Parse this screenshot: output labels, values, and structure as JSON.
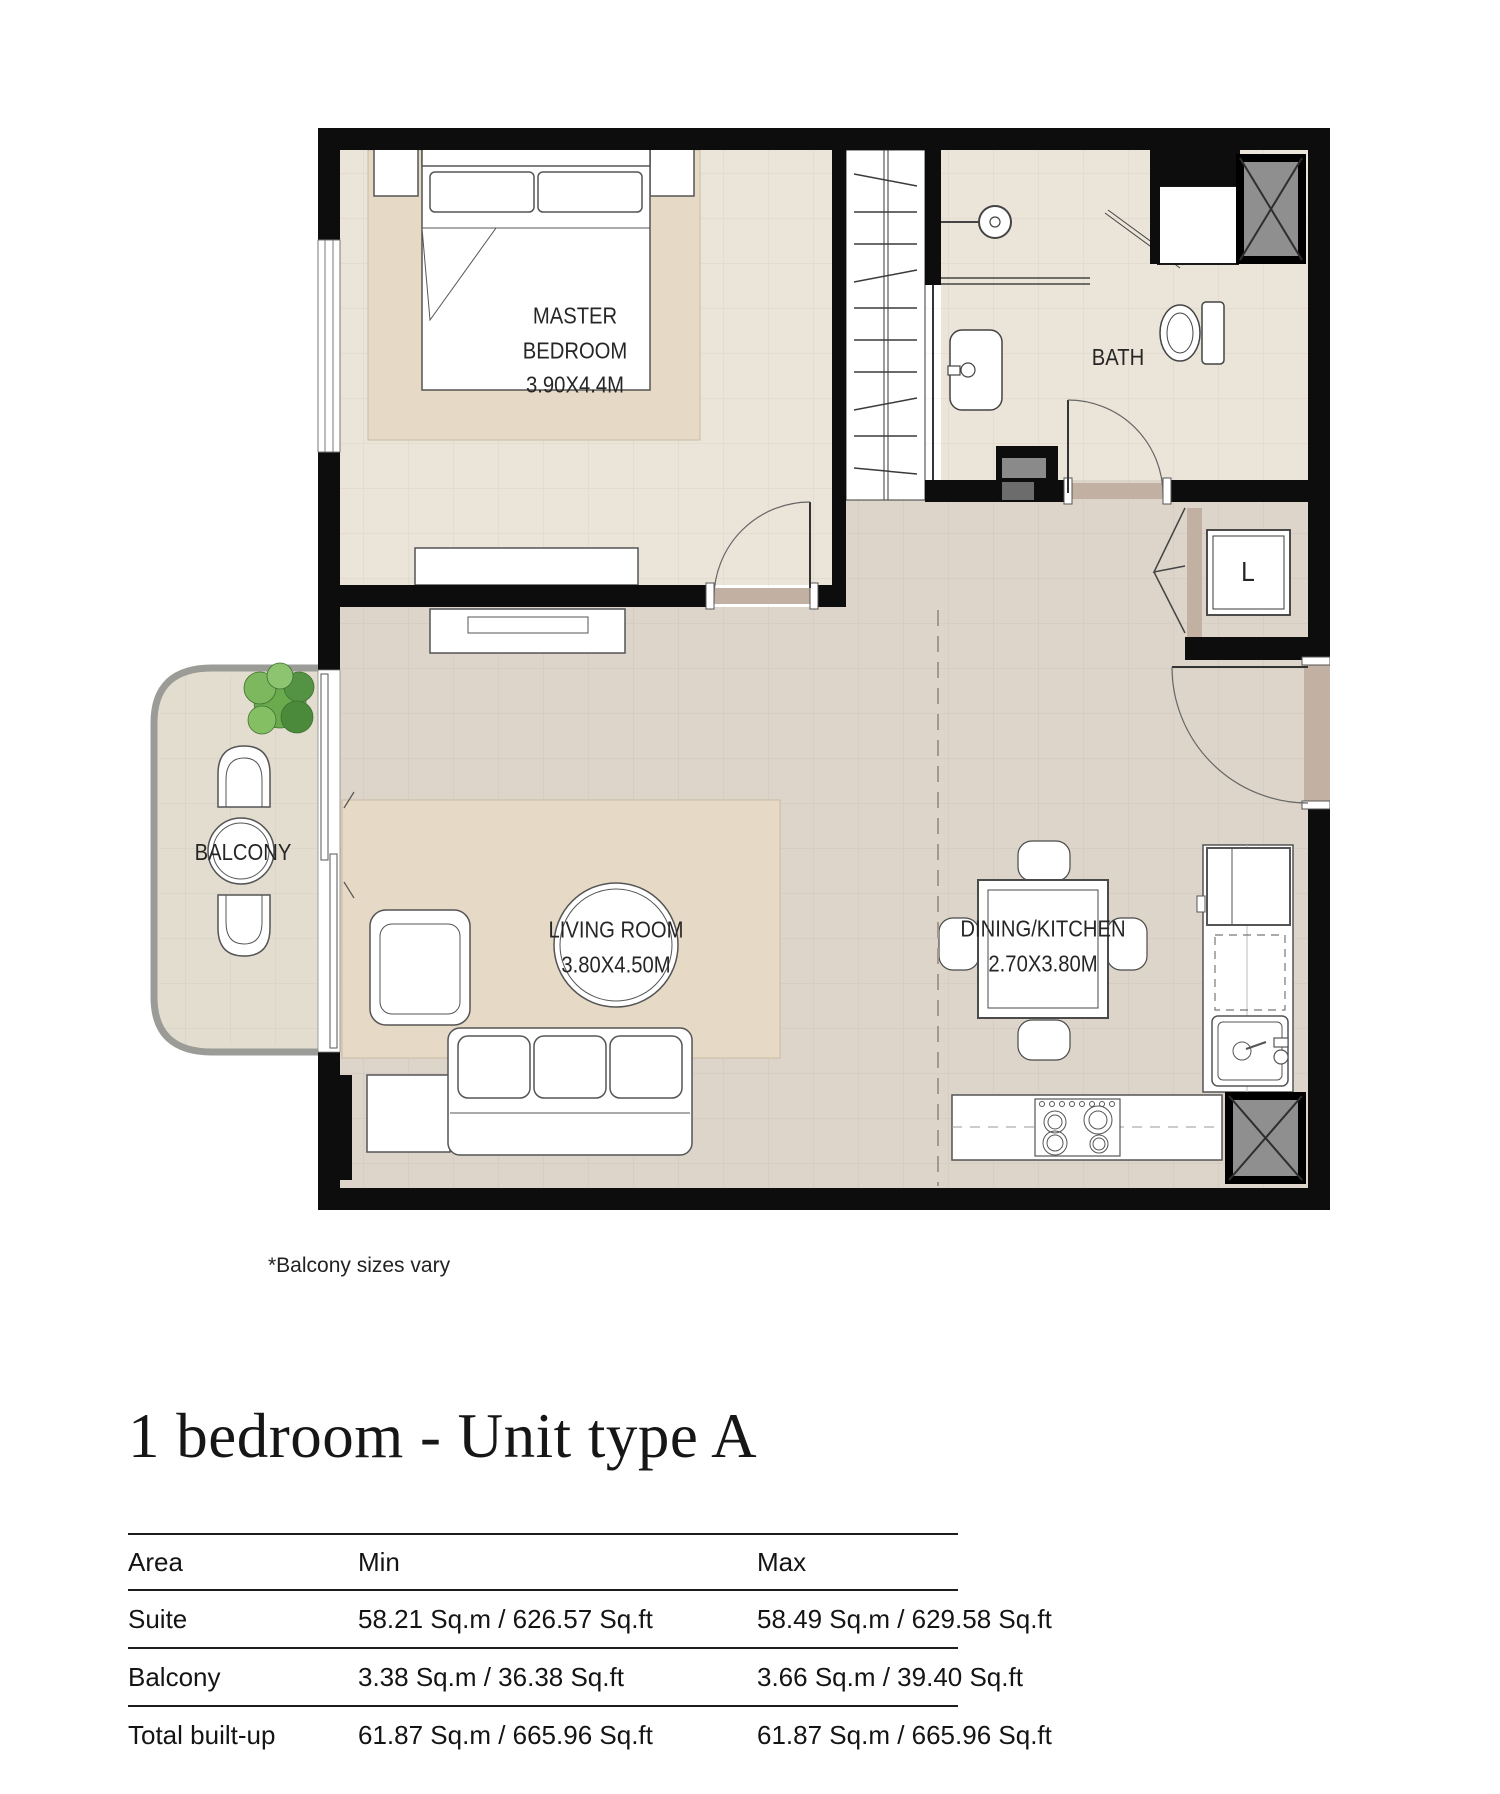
{
  "plan": {
    "rooms": {
      "master_bedroom": {
        "name": "MASTER BEDROOM",
        "dims": "3.90X4.4M"
      },
      "bath": {
        "name": "BATH"
      },
      "laundry": {
        "name": "L"
      },
      "living_room": {
        "name": "LIVING ROOM",
        "dims": "3.80X4.50M"
      },
      "dining_kitchen": {
        "name": "DINING/KITCHEN",
        "dims": "2.70X3.80M"
      },
      "balcony": {
        "name": "BALCONY"
      }
    },
    "note": "*Balcony sizes vary"
  },
  "title": "1 bedroom - Unit type A",
  "area_table": {
    "headers": [
      "Area",
      "Min",
      "Max"
    ],
    "rows": [
      {
        "area": "Suite",
        "min": "58.21 Sq.m / 626.57 Sq.ft",
        "max": "58.49 Sq.m / 629.58 Sq.ft"
      },
      {
        "area": "Balcony",
        "min": "3.38 Sq.m / 36.38 Sq.ft",
        "max": "3.66 Sq.m / 39.40 Sq.ft"
      },
      {
        "area": "Total built-up",
        "min": "61.87 Sq.m / 665.96 Sq.ft",
        "max": "61.87 Sq.m / 665.96 Sq.ft"
      }
    ]
  },
  "colors": {
    "wall": "#0d0d0d",
    "floor_light": "#ebe4d9",
    "floor_dark": "#ddd5c9",
    "rug": "#e6dac6",
    "threshold": "#c2b0a2",
    "railing": "#9b9b97",
    "shaft": "#8f8f8f",
    "plant": "#6aab4e"
  }
}
